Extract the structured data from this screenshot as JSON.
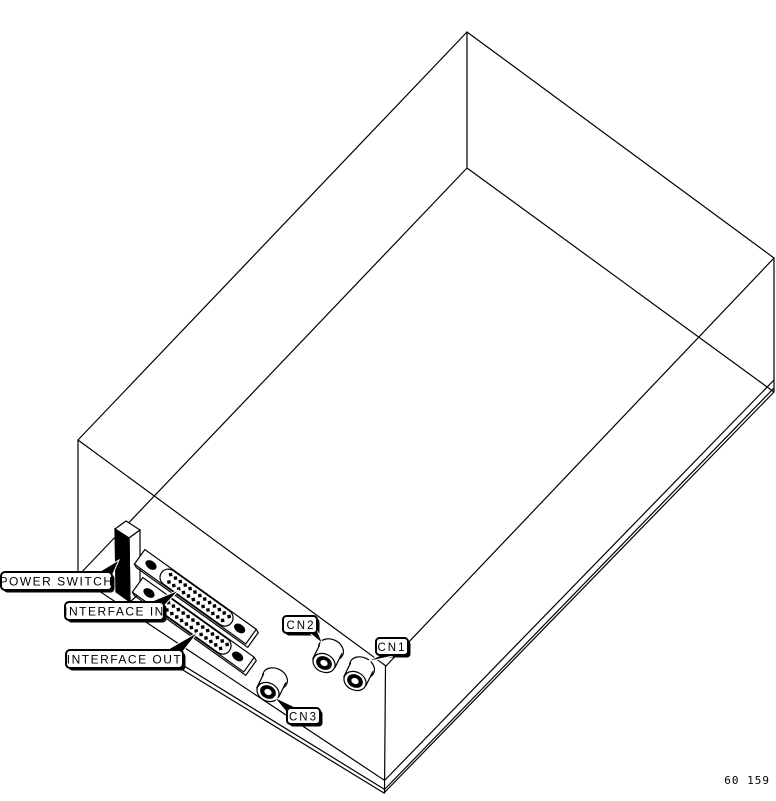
{
  "canvas": {
    "background": "#ffffff",
    "line_color": "#000000"
  },
  "diagram": {
    "description": "Isometric black-and-white line drawing of a device chassis seen from the front-left corner, showing the connector panel",
    "components": [
      "power rocker switch",
      "25-pin D-sub connector (interface in)",
      "25-pin D-sub connector (interface out)",
      "round connector CN1",
      "round connector CN2",
      "round connector CN3"
    ]
  },
  "labels": {
    "power_switch": "POWER SWITCH",
    "interface_in": "INTERFACE IN",
    "interface_out": "INTERFACE OUT",
    "cn1": "CN1",
    "cn2": "CN2",
    "cn3": "CN3"
  },
  "figure_number": "60 159"
}
